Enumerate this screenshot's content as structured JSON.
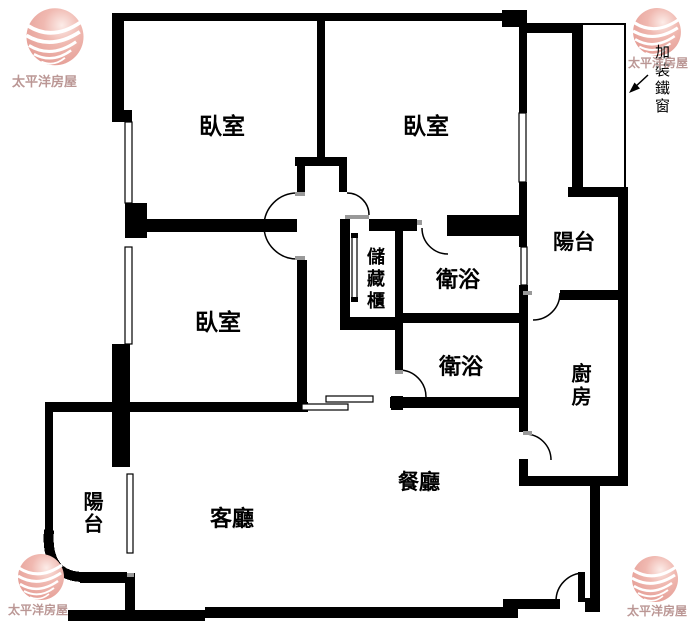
{
  "brand": {
    "logo_text": "太平洋房屋"
  },
  "annotation": {
    "iron_window_note": "加裝鐵窗"
  },
  "rooms": {
    "bedroom_top_left": "臥室",
    "bedroom_top_right": "臥室",
    "bedroom_bottom_left": "臥室",
    "bathroom_upper": "衛浴",
    "bathroom_lower": "衛浴",
    "kitchen": "廚房",
    "dining_room": "餐廳",
    "living_room": "客廳",
    "balcony_right": "陽台",
    "balcony_left": "陽台",
    "storage_cabinet": "儲藏櫃"
  },
  "colors": {
    "wall": "#000000",
    "background": "#ffffff",
    "logo_sphere": "#eba9a2",
    "logo_text": "#bb9795",
    "annotation_text": "#000000"
  }
}
